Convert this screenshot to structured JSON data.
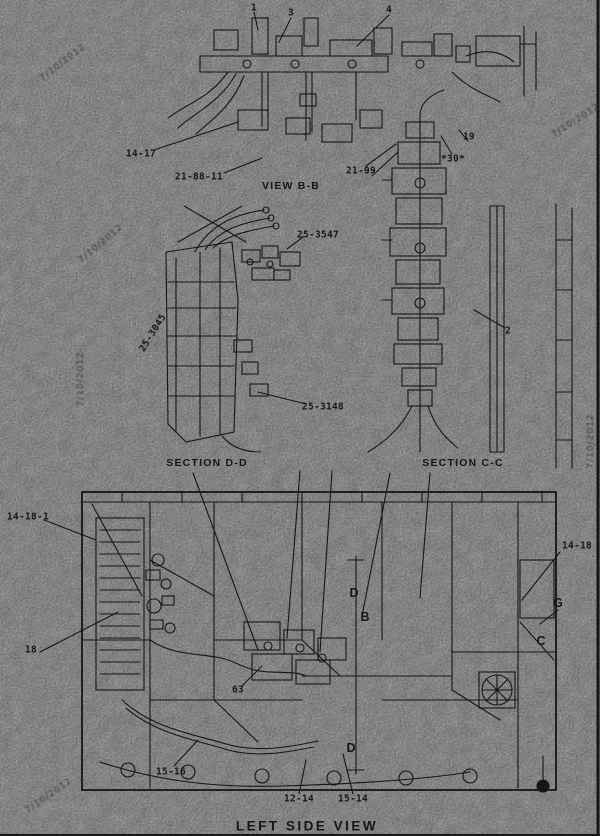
{
  "image": {
    "kind": "scanned engine parts line diagram",
    "background_color": "#a2a2a2",
    "ink_color": "#1c1c1c",
    "watermark_color": "#3e3e3e"
  },
  "captions": {
    "view_bb": "VIEW B-B",
    "section_dd": "SECTION D-D",
    "section_cc": "SECTION C-C",
    "left_side_view": "LEFT SIDE VIEW"
  },
  "labels": [
    {
      "name": "callout-1",
      "text": "1",
      "x": 254,
      "y": 8,
      "rot": 0,
      "cls": "callout"
    },
    {
      "name": "callout-3",
      "text": "3",
      "x": 291,
      "y": 13,
      "rot": 0,
      "cls": "callout"
    },
    {
      "name": "callout-4",
      "text": "4",
      "x": 389,
      "y": 10,
      "rot": 0,
      "cls": "callout"
    },
    {
      "name": "callout-14-17",
      "text": "14-17",
      "x": 141,
      "y": 154,
      "rot": 0,
      "cls": "callout"
    },
    {
      "name": "callout-21-88-11",
      "text": "21-88-11",
      "x": 199,
      "y": 177,
      "rot": 0,
      "cls": "callout"
    },
    {
      "name": "caption-view-bb",
      "text": "VIEW B-B",
      "x": 291,
      "y": 186,
      "rot": 0,
      "cls": "caption"
    },
    {
      "name": "callout-21-99",
      "text": "21-99",
      "x": 361,
      "y": 171,
      "rot": 0,
      "cls": "callout"
    },
    {
      "name": "callout-19",
      "text": "19",
      "x": 469,
      "y": 137,
      "rot": 0,
      "cls": "callout"
    },
    {
      "name": "callout-30",
      "text": "*30*",
      "x": 453,
      "y": 159,
      "rot": 0,
      "cls": "callout"
    },
    {
      "name": "callout-25-3547",
      "text": "25-3547",
      "x": 318,
      "y": 235,
      "rot": 0,
      "cls": "callout"
    },
    {
      "name": "callout-25-3045",
      "text": "25-3045",
      "x": 153,
      "y": 333,
      "rot": -58,
      "cls": "callout"
    },
    {
      "name": "callout-25-3148",
      "text": "25-3148",
      "x": 323,
      "y": 407,
      "rot": 0,
      "cls": "callout"
    },
    {
      "name": "callout-2",
      "text": "2",
      "x": 508,
      "y": 331,
      "rot": 0,
      "cls": "callout"
    },
    {
      "name": "caption-section-dd",
      "text": "SECTION D-D",
      "x": 207,
      "y": 463,
      "rot": 0,
      "cls": "caption"
    },
    {
      "name": "caption-section-cc",
      "text": "SECTION C-C",
      "x": 463,
      "y": 463,
      "rot": 0,
      "cls": "caption"
    },
    {
      "name": "callout-14-18-1",
      "text": "14-18-1",
      "x": 28,
      "y": 517,
      "rot": 0,
      "cls": "callout"
    },
    {
      "name": "callout-18",
      "text": "18",
      "x": 31,
      "y": 650,
      "rot": 0,
      "cls": "callout"
    },
    {
      "name": "callout-14-18",
      "text": "14-18",
      "x": 577,
      "y": 546,
      "rot": 0,
      "cls": "callout"
    },
    {
      "name": "letter-d-upper",
      "text": "D",
      "x": 354,
      "y": 593,
      "rot": 0,
      "cls": "letter"
    },
    {
      "name": "letter-b-upper",
      "text": "B",
      "x": 365,
      "y": 617,
      "rot": 0,
      "cls": "letter"
    },
    {
      "name": "letter-d-lower",
      "text": "D",
      "x": 351,
      "y": 748,
      "rot": 0,
      "cls": "letter"
    },
    {
      "name": "letter-c",
      "text": "C",
      "x": 541,
      "y": 641,
      "rot": 0,
      "cls": "letter"
    },
    {
      "name": "letter-g",
      "text": "G",
      "x": 558,
      "y": 603,
      "rot": 0,
      "cls": "letter"
    },
    {
      "name": "callout-63",
      "text": "63",
      "x": 238,
      "y": 690,
      "rot": 0,
      "cls": "callout"
    },
    {
      "name": "callout-15-16",
      "text": "15-16",
      "x": 171,
      "y": 772,
      "rot": 0,
      "cls": "callout"
    },
    {
      "name": "callout-12-14",
      "text": "12-14",
      "x": 299,
      "y": 799,
      "rot": 0,
      "cls": "callout"
    },
    {
      "name": "callout-15-14",
      "text": "15-14",
      "x": 353,
      "y": 799,
      "rot": 0,
      "cls": "callout"
    },
    {
      "name": "title-left-side-view",
      "text": "LEFT SIDE VIEW",
      "x": 307,
      "y": 826,
      "rot": 0,
      "cls": "title"
    },
    {
      "name": "watermark-top-left",
      "text": "7/10/2012",
      "x": 63,
      "y": 63,
      "rot": -38,
      "cls": "wm"
    },
    {
      "name": "watermark-top-right",
      "text": "7/10/2012",
      "x": 576,
      "y": 121,
      "rot": -33,
      "cls": "wm"
    },
    {
      "name": "watermark-mid-left",
      "text": "7/10/2012",
      "x": 101,
      "y": 244,
      "rot": -40,
      "cls": "wm"
    },
    {
      "name": "watermark-left-vertical",
      "text": "7/10/2012",
      "x": 81,
      "y": 379,
      "rot": -90,
      "cls": "wm"
    },
    {
      "name": "watermark-right-vertical",
      "text": "7/10/2012",
      "x": 591,
      "y": 441,
      "rot": -90,
      "cls": "wm"
    },
    {
      "name": "watermark-bottom-left",
      "text": "7/10/2012",
      "x": 49,
      "y": 796,
      "rot": -35,
      "cls": "wm"
    }
  ]
}
